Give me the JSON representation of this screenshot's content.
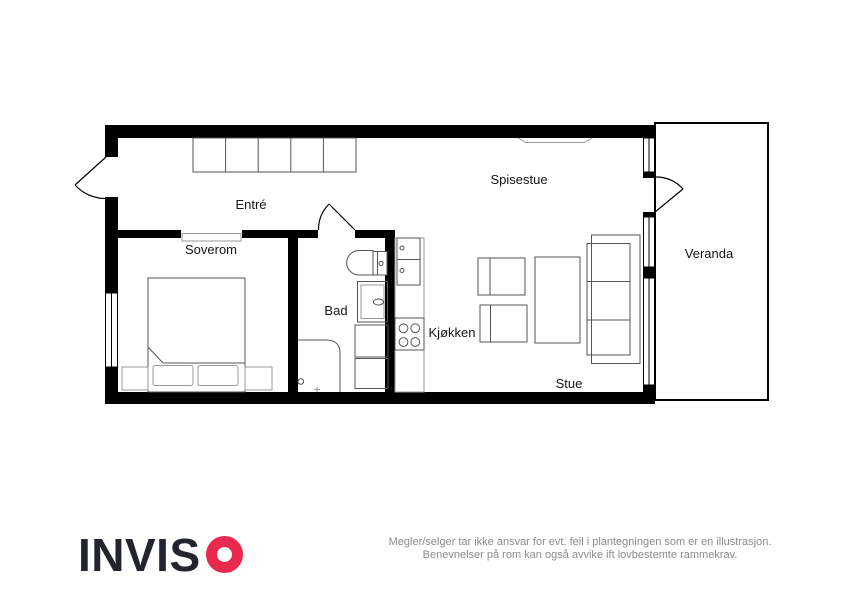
{
  "plan": {
    "rooms": {
      "entre": "Entré",
      "spisestue": "Spisestue",
      "soverom": "Soverom",
      "bad": "Bad",
      "kjokken": "Kjøkken",
      "stue": "Stue",
      "veranda": "Veranda"
    }
  },
  "footer": {
    "logo": {
      "brand": "INVISO",
      "letters": "INVIS"
    },
    "disclaimer_line1": "Megler/selger tar ikke ansvar for evt. feil i plantegningen som er en illustrasjon.",
    "disclaimer_line2": "Benevnelser på rom kan også avvike ift lovbestemte rammekrav."
  },
  "colors": {
    "wall": "#000000",
    "furniture": "#555555",
    "furniture_light": "#9a9a9a",
    "brand_red": "#e92a4e",
    "logo_text": "#23252e",
    "disclaimer_text": "#8b8b8b"
  }
}
